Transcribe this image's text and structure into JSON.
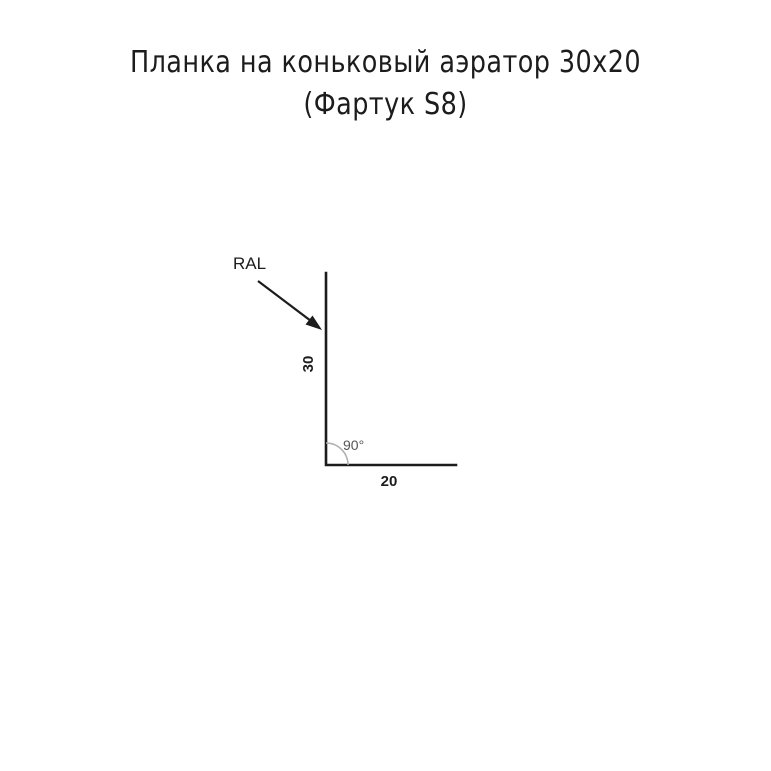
{
  "page": {
    "background_color": "#ffffff"
  },
  "title": {
    "line1": "Планка на коньковый аэратор 30x20",
    "line2": "(Фартук S8)"
  },
  "drawing": {
    "material_label": "RAL",
    "height_dim": "30",
    "width_dim": "20",
    "angle_label": "90°",
    "line_color": "#1c1c1c",
    "arc_color": "#b0b0b0",
    "label_color": "#1c1c1c",
    "angle_text_color": "#555555"
  }
}
